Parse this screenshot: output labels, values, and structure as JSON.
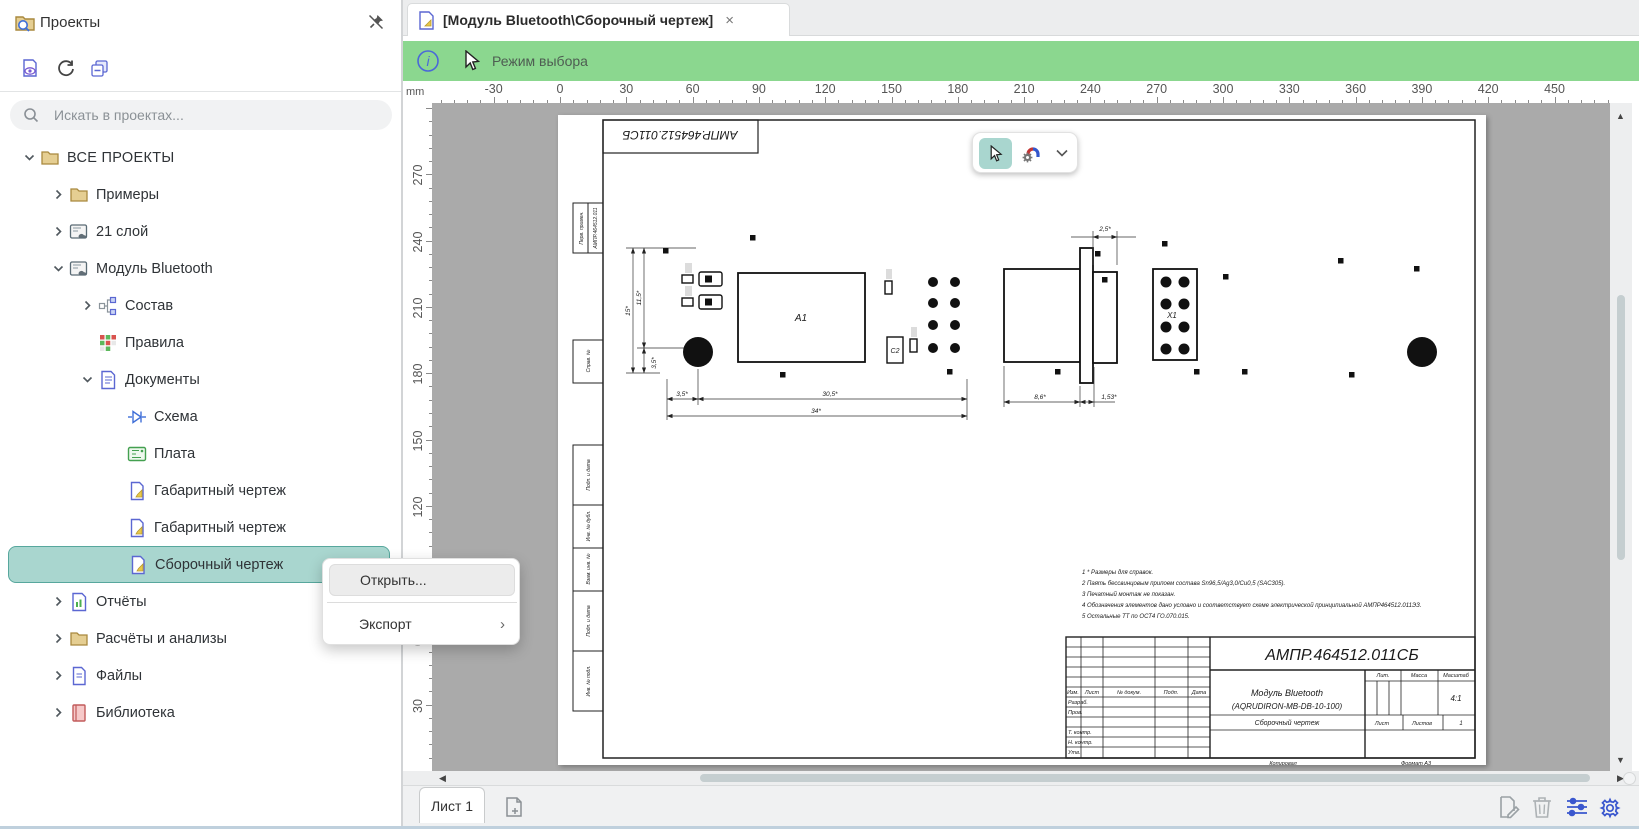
{
  "colors": {
    "accent_green": "#8bd78f",
    "selection_teal": "#a9d6cf",
    "canvas_gray": "#aaaaaa",
    "accent_blue": "#4a68d8"
  },
  "sidebar": {
    "title": "Проекты",
    "toolbar_icons": [
      "document-visibility-icon",
      "refresh-icon",
      "collapse-all-icon"
    ],
    "search": {
      "placeholder": "Искать в проектах..."
    },
    "tree": [
      {
        "label": "ВСЕ ПРОЕКТЫ",
        "icon": "folder-icon",
        "level": 0,
        "chevron": "down",
        "selected": false
      },
      {
        "label": "Примеры",
        "icon": "folder-icon",
        "level": 1,
        "chevron": "right",
        "selected": false
      },
      {
        "label": "21 слой",
        "icon": "project-icon",
        "level": 1,
        "chevron": "right",
        "selected": false
      },
      {
        "label": "Модуль Bluetooth",
        "icon": "project-icon",
        "level": 1,
        "chevron": "down",
        "selected": false
      },
      {
        "label": "Состав",
        "icon": "structure-icon",
        "level": 2,
        "chevron": "right",
        "selected": false
      },
      {
        "label": "Правила",
        "icon": "rules-icon",
        "level": 2,
        "chevron": null,
        "selected": false
      },
      {
        "label": "Документы",
        "icon": "documents-icon",
        "level": 2,
        "chevron": "down",
        "selected": false
      },
      {
        "label": "Схема",
        "icon": "schematic-icon",
        "level": 3,
        "chevron": null,
        "selected": false
      },
      {
        "label": "Плата",
        "icon": "board-icon",
        "level": 3,
        "chevron": null,
        "selected": false
      },
      {
        "label": "Габаритный чертеж",
        "icon": "drawing-doc-icon",
        "level": 3,
        "chevron": null,
        "selected": false
      },
      {
        "label": "Габаритный чертеж",
        "icon": "drawing-doc-icon",
        "level": 3,
        "chevron": null,
        "selected": false
      },
      {
        "label": "Сборочный чертеж",
        "icon": "drawing-doc-icon",
        "level": 3,
        "chevron": null,
        "selected": true
      },
      {
        "label": "Отчёты",
        "icon": "reports-icon",
        "level": 1,
        "chevron": "right",
        "selected": false
      },
      {
        "label": "Расчёты и анализы",
        "icon": "folder-icon",
        "level": 1,
        "chevron": "right",
        "selected": false
      },
      {
        "label": "Файлы",
        "icon": "files-icon",
        "level": 1,
        "chevron": "right",
        "selected": false
      },
      {
        "label": "Библиотека",
        "icon": "library-icon",
        "level": 1,
        "chevron": "right",
        "selected": false
      }
    ]
  },
  "context_menu": {
    "items": [
      {
        "label": "Открыть...",
        "highlighted": true,
        "submenu": false
      },
      {
        "label": "Экспорт",
        "highlighted": false,
        "submenu": true
      }
    ]
  },
  "tab": {
    "title": "[Модуль Bluetooth\\Сборочный чертеж]",
    "close": "×"
  },
  "mode_bar": {
    "label": "Режим выбора"
  },
  "ruler": {
    "unit": "mm",
    "h_labels": [
      -30,
      0,
      30,
      60,
      90,
      120,
      150,
      180,
      210,
      240,
      270,
      300,
      330,
      360,
      390,
      420,
      450
    ],
    "v_labels": [
      270,
      240,
      210,
      180,
      150,
      120,
      90,
      60,
      30
    ]
  },
  "bottom": {
    "sheet_tab": "Лист 1"
  },
  "drawing": {
    "stamp": "АМПР.464512.011СБ",
    "dims": {
      "d15": "15*",
      "d115": "11,5*",
      "d35v": "3,5*",
      "d35h": "3,5*",
      "d305": "30,5*",
      "d34": "34*",
      "d25": "2,5*",
      "d86": "8,6*",
      "d153": "1,53*"
    },
    "refdes": {
      "a1": "A1",
      "c2": "C2",
      "x1": "X1"
    },
    "notes": [
      "1 * Размеры для справок.",
      "2 Паять бессвинцовым припоем состава Sn96,5/Ag3,0/Cu0,5 (SAC305).",
      "3 Печатный монтаж не показан.",
      "4 Обозначения элементов дано условно и соответствует схеме электрической принципиальной АМПР464512.011ЭЗ.",
      "5 Остальные ТТ по ОСТ4 ГО.070.015."
    ],
    "side_labels": [
      "Перв. примен.",
      "АМПР.464512.011",
      "Справ. №",
      "Подп. и дата",
      "Инв. № дубл.",
      "Взам. инв. №",
      "Подп. и дата",
      "Инв. № подл."
    ],
    "title_block": {
      "doc_number": "АМПР.464512.011СБ",
      "product_name": "Модуль Bluetooth",
      "product_code": "(AQRUDIRON-MB-DB-10-100)",
      "doc_type": "Сборочный чертеж",
      "scale": "4:1",
      "sheets_value": "1",
      "labels": {
        "izm": "Изм.",
        "list": "Лист",
        "n_doc": "№ докум.",
        "podp": "Подп.",
        "data": "Дата",
        "razrab": "Разраб.",
        "prov": "Пров.",
        "t_contr": "Т. контр.",
        "n_contr": "Н. контр.",
        "utv": "Утв.",
        "lit": "Лит.",
        "massa": "Масса",
        "masshtab": "Масштаб",
        "list2": "Лист",
        "listov": "Листов",
        "kopiroval": "Копировал",
        "format": "Формат А3"
      }
    }
  }
}
